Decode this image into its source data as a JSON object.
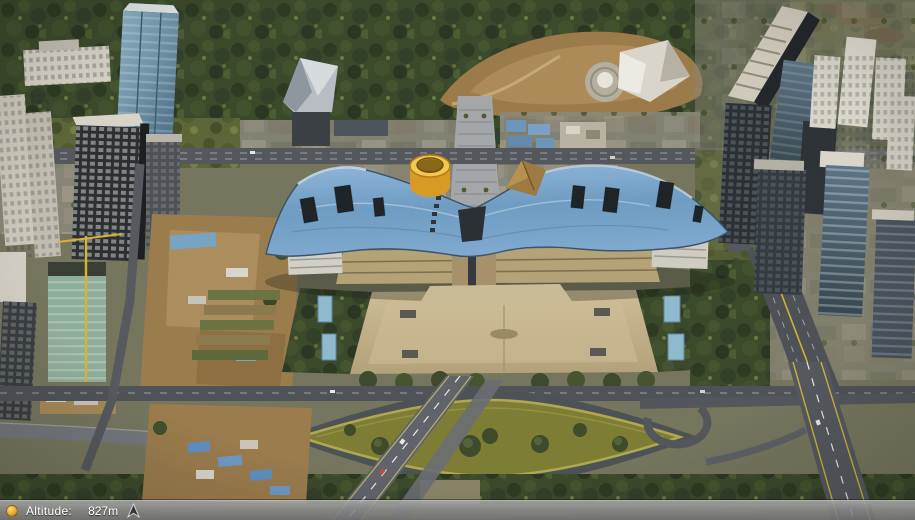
{
  "app": {
    "name": "3d-map-viewer"
  },
  "status_bar": {
    "altitude_label": "Altitude:",
    "altitude_value": "827m",
    "left_icon": "streaming-indicator-icon",
    "right_icon": "compass-arrow-icon"
  },
  "colors": {
    "status_bar_top": "#a8a8a8",
    "status_bar_bottom": "#707070",
    "status_text": "#ffffff",
    "indicator_orange": "#e8a83a",
    "arrow_dark": "#33363a",
    "civic_roof_blue": "#7aa6cc",
    "cylinder_yellow": "#e8b73e",
    "pyramid_brown": "#9c7a42",
    "plaza_tan": "#c3b28c",
    "forest_green": "#3c4a2c",
    "lens_park_olive": "#7e7d35",
    "road_gray": "#54585c"
  },
  "scene": {
    "regions": [
      "forest-park",
      "hillside",
      "central-promenade",
      "civic-center-roof",
      "civic-square",
      "lens-shaped-park",
      "highway-left",
      "highway-right",
      "skyscrapers-left",
      "skyscrapers-right",
      "construction-site"
    ]
  }
}
